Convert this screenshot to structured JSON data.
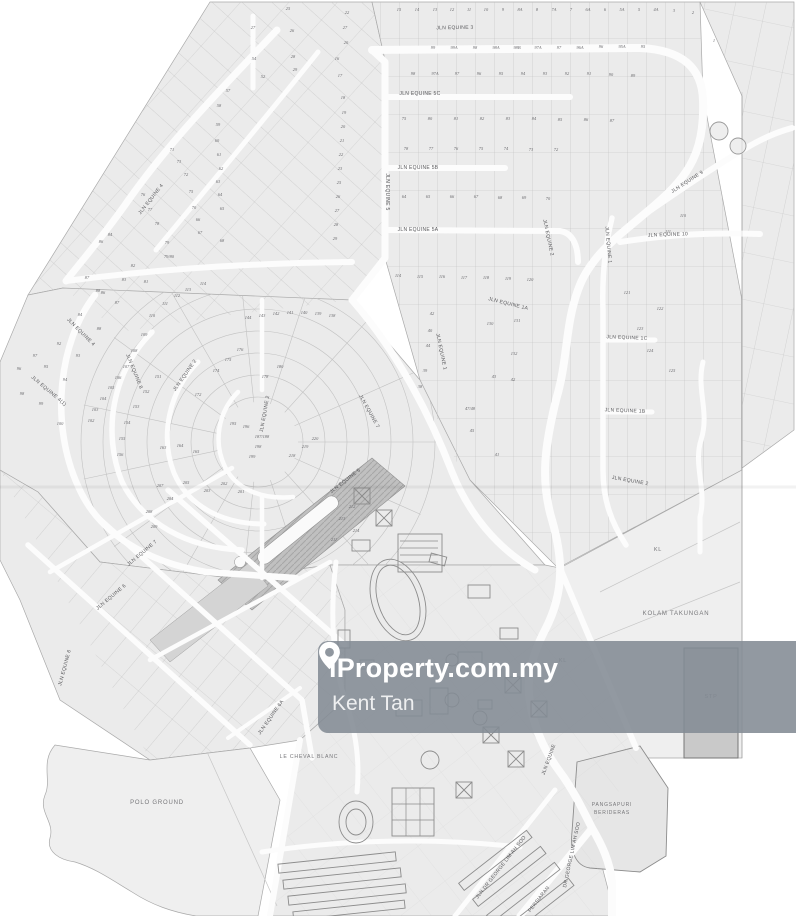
{
  "watermark": {
    "brand": "iProperty.com.my",
    "agent": "Kent Tan",
    "pin_icon": "location-pin-icon",
    "band_color": "#838b94",
    "text_color": "#ffffff"
  },
  "map": {
    "type": "scanned site layout plan",
    "colors": {
      "paper": "#ffffff",
      "parcel_fill": "#ebebeb",
      "parcel_line": "#bfbfbf",
      "road": "#fcfcfc",
      "label": "#57575a",
      "dark_strip": "#c0c0c0"
    },
    "street_labels": [
      [
        455,
        29,
        "JLN EQUINE 3",
        -1
      ],
      [
        420,
        95,
        "JLN EQUINE 5C",
        0
      ],
      [
        418,
        169,
        "JLN EQUINE 5B",
        0
      ],
      [
        418,
        231,
        "JLN EQUINE 5A",
        0
      ],
      [
        386,
        192,
        "JLN EQUINE 5",
        90
      ],
      [
        688,
        183,
        "JLN EQUINE 9",
        -33
      ],
      [
        668,
        236,
        "JLN EQUINE 10",
        -2
      ],
      [
        607,
        245,
        "JLN EQUINE 1",
        85
      ],
      [
        627,
        339,
        "JLN EQUINE 1C",
        2
      ],
      [
        625,
        412,
        "JLN EQUINE 1B",
        2
      ],
      [
        508,
        305,
        "JLN EQUINE 1A",
        14
      ],
      [
        440,
        352,
        "JLN EQUINE 1",
        78
      ],
      [
        547,
        238,
        "JLN EQUINE 2",
        78
      ],
      [
        152,
        200,
        "JLN EQUINE 4",
        -52
      ],
      [
        80,
        333,
        "JLN EQUINE 4",
        45
      ],
      [
        48,
        392,
        "JLN EQUINE 4(1)",
        40
      ],
      [
        133,
        372,
        "JLN EQUINE 8",
        68
      ],
      [
        186,
        376,
        "JLN EQUINE 2",
        -55
      ],
      [
        266,
        414,
        "JLN EQUINE 2",
        -80
      ],
      [
        368,
        412,
        "JLN EQUINE 7",
        61
      ],
      [
        346,
        482,
        "JLN EQUINE 5",
        -38
      ],
      [
        630,
        482,
        "JLN EQUINE 2",
        10
      ],
      [
        143,
        554,
        "JLN EQUINE 7",
        -40
      ],
      [
        112,
        598,
        "JLN EQUINE 6",
        -40
      ],
      [
        66,
        668,
        "JLN EQUINE 6",
        -75
      ],
      [
        272,
        718,
        "JLN EQUINE 6A",
        -55
      ],
      [
        550,
        760,
        "JLN EQUINE",
        -70
      ],
      [
        573,
        855,
        "DR GEORGE LIM AH SOO",
        -78
      ],
      [
        540,
        900,
        "PERSIARAN",
        -52
      ],
      [
        502,
        868,
        "JLN DR GEORGE LIM AH SOO",
        -52
      ]
    ],
    "area_labels": [
      [
        157,
        804,
        "POLO GROUND",
        0,
        6
      ],
      [
        309,
        758,
        "LE CHEVAL BLANC",
        0,
        5.2
      ],
      [
        676,
        615,
        "KOLAM TAKUNGAN",
        0,
        6
      ],
      [
        658,
        551,
        "KL",
        0,
        5.5
      ],
      [
        563,
        662,
        "KL",
        0,
        5.5
      ],
      [
        711,
        698,
        "STP",
        0,
        5.5
      ],
      [
        612,
        806,
        "PANGSAPURI",
        0,
        5
      ],
      [
        612,
        814,
        "BERIDERAS",
        0,
        5
      ]
    ],
    "plot_numbers": [
      [
        399,
        11,
        "15"
      ],
      [
        417,
        11,
        "14"
      ],
      [
        435,
        11,
        "13"
      ],
      [
        452,
        11,
        "12"
      ],
      [
        469,
        11,
        "11"
      ],
      [
        486,
        11,
        "10"
      ],
      [
        503,
        11,
        "9"
      ],
      [
        520,
        11,
        "8A"
      ],
      [
        537,
        11,
        "8"
      ],
      [
        554,
        11,
        "7A"
      ],
      [
        571,
        11,
        "7"
      ],
      [
        588,
        11,
        "6A"
      ],
      [
        605,
        11,
        "6"
      ],
      [
        622,
        11,
        "5A"
      ],
      [
        639,
        11,
        "5"
      ],
      [
        656,
        11,
        "4A"
      ],
      [
        674,
        12,
        "3"
      ],
      [
        693,
        14,
        "2"
      ],
      [
        714,
        42,
        "1"
      ],
      [
        433,
        49,
        "99"
      ],
      [
        454,
        49,
        "99A"
      ],
      [
        475,
        49,
        "98"
      ],
      [
        496,
        49,
        "98A"
      ],
      [
        517,
        49,
        "98B"
      ],
      [
        538,
        49,
        "97A"
      ],
      [
        559,
        49,
        "97"
      ],
      [
        580,
        49,
        "96A"
      ],
      [
        601,
        48,
        "96"
      ],
      [
        622,
        48,
        "95A"
      ],
      [
        643,
        48,
        "95"
      ],
      [
        413,
        75,
        "98"
      ],
      [
        435,
        75,
        "97A"
      ],
      [
        457,
        75,
        "97"
      ],
      [
        479,
        75,
        "96"
      ],
      [
        501,
        75,
        "95"
      ],
      [
        523,
        75,
        "94"
      ],
      [
        545,
        75,
        "93"
      ],
      [
        567,
        75,
        "92"
      ],
      [
        589,
        75,
        "91"
      ],
      [
        611,
        76,
        "90"
      ],
      [
        633,
        77,
        "89"
      ],
      [
        404,
        120,
        "75"
      ],
      [
        430,
        120,
        "80"
      ],
      [
        456,
        120,
        "81"
      ],
      [
        482,
        120,
        "82"
      ],
      [
        508,
        120,
        "83"
      ],
      [
        534,
        120,
        "84"
      ],
      [
        560,
        121,
        "85"
      ],
      [
        586,
        121,
        "86"
      ],
      [
        612,
        122,
        "87"
      ],
      [
        406,
        150,
        "78"
      ],
      [
        431,
        150,
        "77"
      ],
      [
        456,
        150,
        "76"
      ],
      [
        481,
        150,
        "75"
      ],
      [
        506,
        150,
        "74"
      ],
      [
        531,
        151,
        "73"
      ],
      [
        556,
        151,
        "72"
      ],
      [
        404,
        198,
        "64"
      ],
      [
        428,
        198,
        "65"
      ],
      [
        452,
        198,
        "66"
      ],
      [
        476,
        198,
        "67"
      ],
      [
        500,
        199,
        "68"
      ],
      [
        524,
        199,
        "69"
      ],
      [
        548,
        200,
        "70"
      ],
      [
        398,
        277,
        "114"
      ],
      [
        420,
        278,
        "115"
      ],
      [
        442,
        278,
        "116"
      ],
      [
        464,
        279,
        "117"
      ],
      [
        486,
        279,
        "118"
      ],
      [
        508,
        280,
        "119"
      ],
      [
        530,
        281,
        "120"
      ],
      [
        288,
        10,
        "25"
      ],
      [
        347,
        14,
        "22"
      ],
      [
        253,
        29,
        "27"
      ],
      [
        292,
        32,
        "26"
      ],
      [
        345,
        29,
        "27"
      ],
      [
        346,
        44,
        "20"
      ],
      [
        293,
        58,
        "28"
      ],
      [
        295,
        71,
        "29"
      ],
      [
        263,
        78,
        "52"
      ],
      [
        254,
        60,
        "54"
      ],
      [
        228,
        92,
        "57"
      ],
      [
        219,
        107,
        "58"
      ],
      [
        218,
        126,
        "59"
      ],
      [
        217,
        142,
        "60"
      ],
      [
        219,
        156,
        "61"
      ],
      [
        221,
        170,
        "62"
      ],
      [
        218,
        183,
        "63"
      ],
      [
        220,
        196,
        "64"
      ],
      [
        222,
        210,
        "65"
      ],
      [
        198,
        221,
        "66"
      ],
      [
        200,
        234,
        "67"
      ],
      [
        222,
        242,
        "68"
      ],
      [
        194,
        209,
        "70"
      ],
      [
        172,
        151,
        "71"
      ],
      [
        186,
        176,
        "72"
      ],
      [
        179,
        163,
        "73"
      ],
      [
        191,
        193,
        "75"
      ],
      [
        143,
        196,
        "76"
      ],
      [
        150,
        211,
        "77"
      ],
      [
        157,
        225,
        "78"
      ],
      [
        167,
        244,
        "79"
      ],
      [
        169,
        258,
        "79/80"
      ],
      [
        146,
        283,
        "81"
      ],
      [
        133,
        267,
        "82"
      ],
      [
        124,
        281,
        "83"
      ],
      [
        110,
        236,
        "84"
      ],
      [
        101,
        243,
        "86"
      ],
      [
        87,
        279,
        "87"
      ],
      [
        98,
        292,
        "88"
      ],
      [
        337,
        60,
        "16"
      ],
      [
        340,
        77,
        "17"
      ],
      [
        343,
        99,
        "18"
      ],
      [
        344,
        114,
        "19"
      ],
      [
        343,
        128,
        "20"
      ],
      [
        342,
        142,
        "21"
      ],
      [
        341,
        156,
        "22"
      ],
      [
        340,
        170,
        "23"
      ],
      [
        339,
        184,
        "25"
      ],
      [
        338,
        198,
        "26"
      ],
      [
        337,
        212,
        "27"
      ],
      [
        336,
        226,
        "28"
      ],
      [
        335,
        240,
        "29"
      ],
      [
        103,
        294,
        "86"
      ],
      [
        117,
        304,
        "87"
      ],
      [
        80,
        316,
        "84"
      ],
      [
        152,
        317,
        "110"
      ],
      [
        99,
        330,
        "88"
      ],
      [
        144,
        336,
        "109"
      ],
      [
        59,
        345,
        "92"
      ],
      [
        134,
        352,
        "108"
      ],
      [
        78,
        357,
        "93"
      ],
      [
        126,
        368,
        "107"
      ],
      [
        46,
        368,
        "95"
      ],
      [
        118,
        379,
        "106"
      ],
      [
        65,
        381,
        "94"
      ],
      [
        111,
        389,
        "105"
      ],
      [
        103,
        400,
        "104"
      ],
      [
        41,
        405,
        "99"
      ],
      [
        95,
        411,
        "103"
      ],
      [
        60,
        425,
        "100"
      ],
      [
        91,
        422,
        "102"
      ],
      [
        22,
        395,
        "98"
      ],
      [
        19,
        370,
        "96"
      ],
      [
        35,
        357,
        "97"
      ],
      [
        203,
        285,
        "114"
      ],
      [
        188,
        291,
        "113"
      ],
      [
        177,
        297,
        "112"
      ],
      [
        165,
        305,
        "111"
      ],
      [
        248,
        319,
        "144"
      ],
      [
        262,
        317,
        "143"
      ],
      [
        276,
        315,
        "142"
      ],
      [
        290,
        314,
        "141"
      ],
      [
        304,
        314,
        "140"
      ],
      [
        318,
        315,
        "139"
      ],
      [
        332,
        317,
        "138"
      ],
      [
        158,
        378,
        "151"
      ],
      [
        146,
        393,
        "152"
      ],
      [
        136,
        408,
        "153"
      ],
      [
        127,
        424,
        "154"
      ],
      [
        122,
        440,
        "155"
      ],
      [
        120,
        456,
        "156"
      ],
      [
        163,
        449,
        "163"
      ],
      [
        180,
        447,
        "164"
      ],
      [
        196,
        453,
        "165"
      ],
      [
        216,
        372,
        "174"
      ],
      [
        228,
        361,
        "175"
      ],
      [
        240,
        351,
        "176"
      ],
      [
        265,
        378,
        "178"
      ],
      [
        280,
        368,
        "180"
      ],
      [
        198,
        396,
        "172"
      ],
      [
        233,
        425,
        "195"
      ],
      [
        246,
        428,
        "196"
      ],
      [
        262,
        438,
        "187/188"
      ],
      [
        258,
        448,
        "198"
      ],
      [
        252,
        458,
        "199"
      ],
      [
        170,
        500,
        "204"
      ],
      [
        186,
        484,
        "205"
      ],
      [
        160,
        487,
        "207"
      ],
      [
        207,
        492,
        "203"
      ],
      [
        224,
        485,
        "202"
      ],
      [
        241,
        493,
        "201"
      ],
      [
        149,
        513,
        "208"
      ],
      [
        154,
        528,
        "209"
      ],
      [
        305,
        448,
        "219"
      ],
      [
        292,
        457,
        "218"
      ],
      [
        315,
        440,
        "220"
      ],
      [
        352,
        508,
        "212"
      ],
      [
        342,
        520,
        "213"
      ],
      [
        356,
        532,
        "214"
      ],
      [
        334,
        541,
        "211"
      ],
      [
        517,
        322,
        "131"
      ],
      [
        514,
        355,
        "132"
      ],
      [
        490,
        325,
        "130"
      ],
      [
        494,
        378,
        "43"
      ],
      [
        513,
        381,
        "42"
      ],
      [
        470,
        410,
        "47/48"
      ],
      [
        497,
        456,
        "41"
      ],
      [
        472,
        432,
        "45"
      ],
      [
        432,
        315,
        "42"
      ],
      [
        430,
        332,
        "40"
      ],
      [
        428,
        347,
        "44"
      ],
      [
        425,
        372,
        "39"
      ],
      [
        420,
        388,
        "38"
      ],
      [
        683,
        217,
        "110"
      ],
      [
        668,
        233,
        "111"
      ],
      [
        660,
        310,
        "122"
      ],
      [
        627,
        294,
        "121"
      ],
      [
        640,
        330,
        "123"
      ],
      [
        650,
        352,
        "124"
      ],
      [
        672,
        372,
        "125"
      ]
    ]
  }
}
